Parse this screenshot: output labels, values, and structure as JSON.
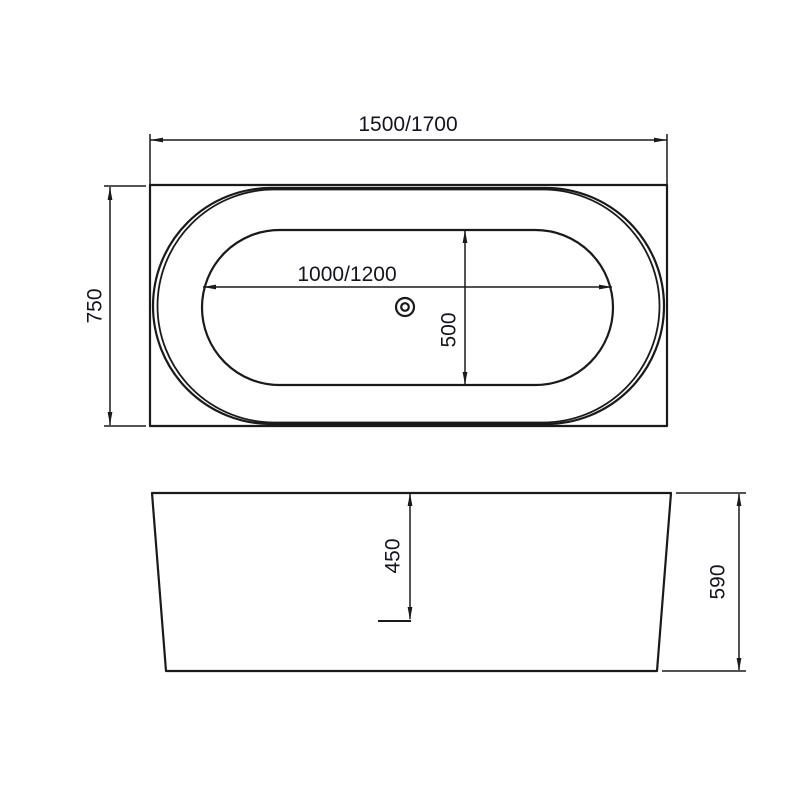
{
  "drawing": {
    "type": "bathtub-dimension-drawing",
    "colors": {
      "line": "#1a1a1a",
      "text": "#14141f",
      "background": "#ffffff"
    },
    "top_view": {
      "overall_length_label": "1500/1700",
      "overall_width_label": "750",
      "basin_length_label": "1000/1200",
      "basin_width_label": "500"
    },
    "front_view": {
      "inner_depth_label": "450",
      "overall_height_label": "590"
    }
  }
}
